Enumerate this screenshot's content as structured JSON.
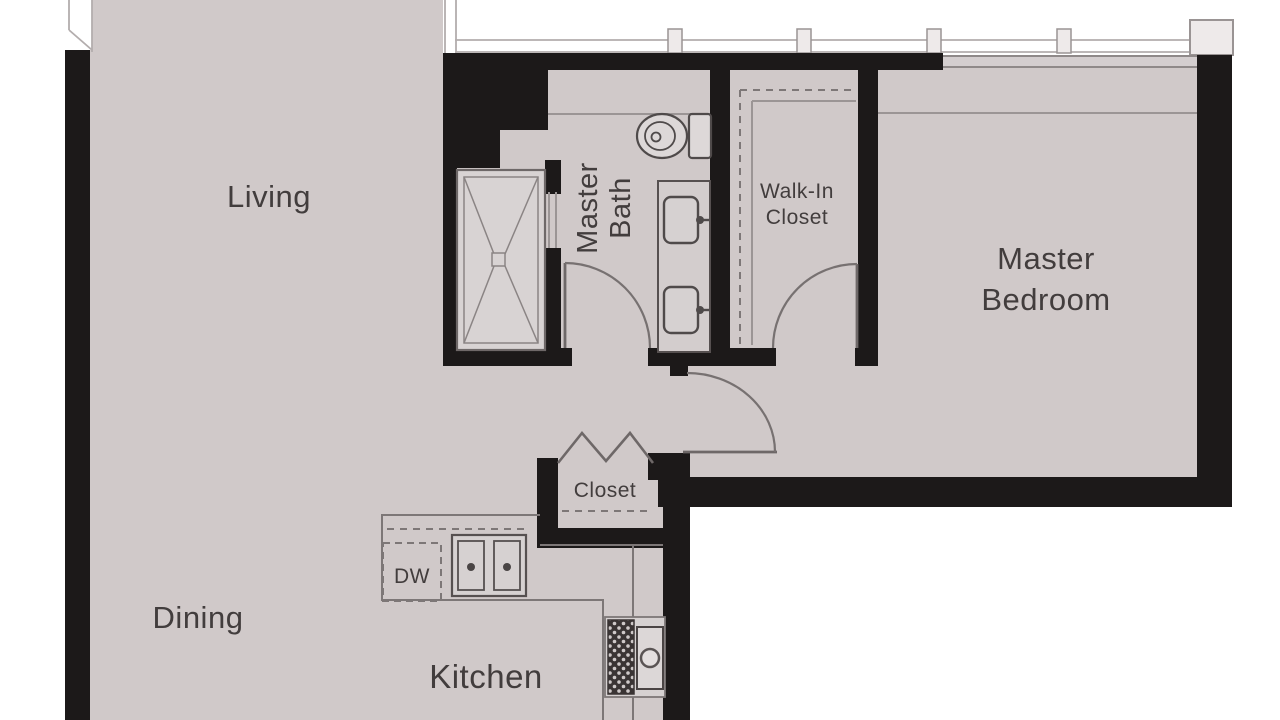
{
  "plan": {
    "title": "residential unit floor plan",
    "rooms": {
      "living": "Living",
      "dining": "Dining",
      "kitchen": "Kitchen",
      "hall_closet": "Closet",
      "dishwasher": "DW",
      "master_bath": {
        "line1": "Master",
        "line2": "Bath"
      },
      "walk_in_closet": {
        "line1": "Walk-In",
        "line2": "Closet"
      },
      "master_bedroom": {
        "line1": "Master",
        "line2": "Bedroom"
      }
    },
    "fixtures": {
      "shower": "walk-in shower with X floor pattern",
      "toilet": "toilet",
      "vanity": "double-sink vanity",
      "kitchen_sink": "double-basin kitchen sink",
      "range": "range with burners and oven",
      "bifold_doors": "bi-fold closet doors",
      "doors": "swing doors with quarter-circle arcs",
      "windows": "exterior window walls with mullions"
    },
    "colors": {
      "floor": "#d0c9c9",
      "wall": "#1c1919",
      "line": "#7d7777",
      "text": "#423d3d",
      "background": "#ffffff",
      "shower_floor": "#d8d3d3"
    }
  }
}
